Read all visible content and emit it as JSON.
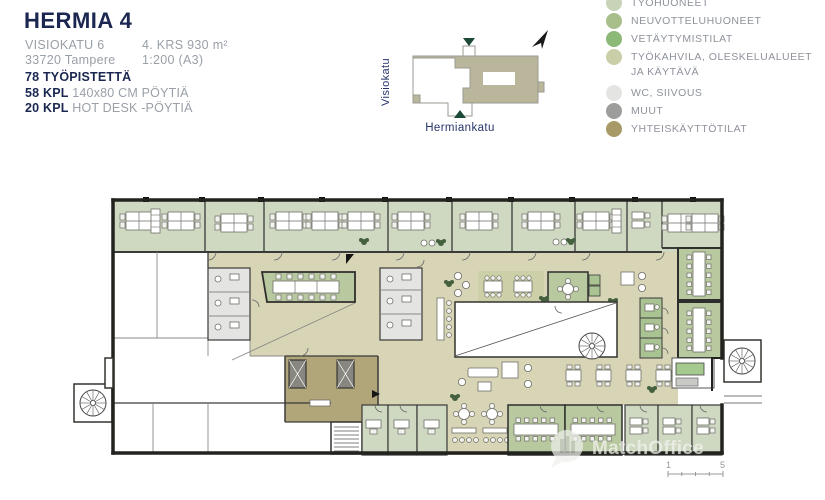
{
  "header": {
    "title": "HERMIA 4",
    "address_line1": "VISIOKATU 6",
    "address_line2": "33720 Tampere",
    "floor_area": "4. KRS 930 m²",
    "scale": "1:200 (A3)",
    "stat_workstations": "78 TYÖPISTETTÄ",
    "stat_desks_count": "58 KPL",
    "stat_desks_desc": " 140x80 CM PÖYTIÄ",
    "stat_hotdesk_count": "20 KPL",
    "stat_hotdesk_desc": " HOT DESK -PÖYTIÄ"
  },
  "site_map": {
    "street_left": "Visiokatu",
    "street_bottom": "Hermiankatu"
  },
  "legend": {
    "items": [
      {
        "label": "TYÖHUONEET",
        "color": "#c9d3b8"
      },
      {
        "label": "NEUVOTTELUHUONEET",
        "color": "#a9bf8b"
      },
      {
        "label": "VETÄYTYMISTILAT",
        "color": "#8cb978"
      },
      {
        "label": "TYÖKAHVILA, OLESKELUALUEET",
        "label2": "JA KÄYTÄVÄ",
        "color": "#cbcfa7"
      },
      {
        "label": "WC, SIIVOUS",
        "color": "#e4e5e3"
      },
      {
        "label": "MUUT",
        "color": "#9d9d9b"
      },
      {
        "label": "YHTEISKÄYTTÖTILAT",
        "color": "#a89a66"
      }
    ]
  },
  "plan_colors": {
    "office": "#cfd8c1",
    "meeting": "#b8c9a0",
    "retreat": "#a9c392",
    "cafe_corridor": "#d8d4b6",
    "wc": "#e4e4e2",
    "common": "#b1a57a",
    "wall": "#22221e"
  },
  "watermark": {
    "text": "MatchOffice"
  },
  "scale_bar": {
    "start": "1",
    "end": "5"
  }
}
